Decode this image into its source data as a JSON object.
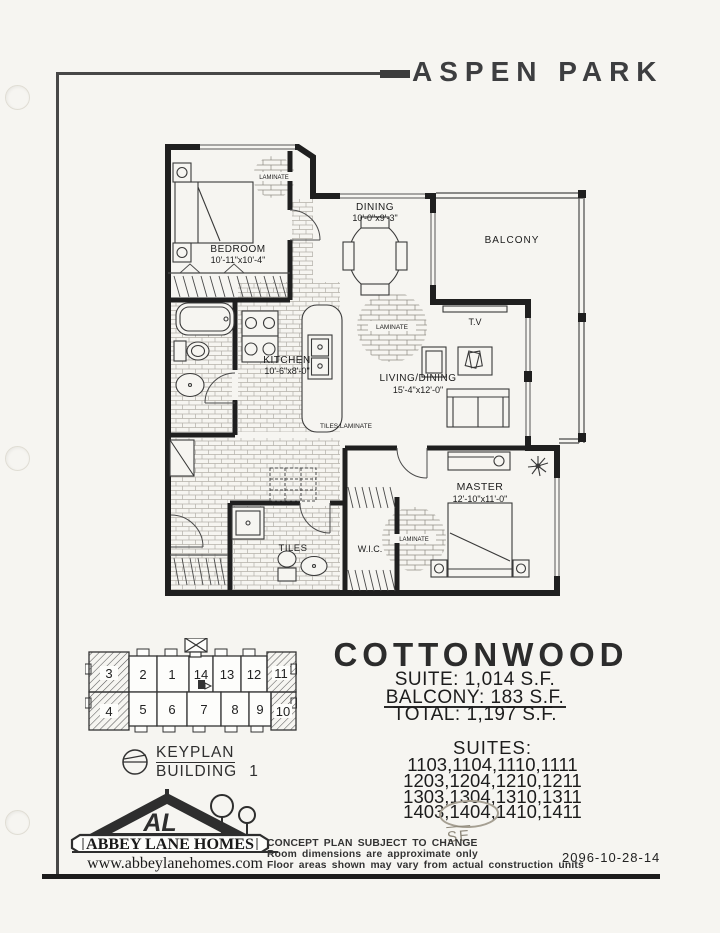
{
  "header": {
    "title": "ASPEN PARK"
  },
  "floorplan": {
    "rooms": {
      "bedroom": {
        "name": "BEDROOM",
        "dims": "10'-11\"x10'-4\""
      },
      "dining": {
        "name": "DINING",
        "dims": "10'-0\"x9'-3\""
      },
      "balcony": {
        "name": "BALCONY"
      },
      "kitchen": {
        "name": "KITCHEN",
        "dims": "10'-6\"x8'-0\""
      },
      "living": {
        "name": "LIVING/DINING",
        "dims": "15'-4\"x12'-0\""
      },
      "master": {
        "name": "MASTER",
        "dims": "12'-10\"x11'-0\""
      },
      "wic": {
        "name": "W.I.C."
      }
    },
    "labels": {
      "tv": "T.V",
      "tiles": "TILES",
      "tiles_laminate": "TILES LAMINATE",
      "laminate": "LAMINATE"
    }
  },
  "plan": {
    "name": "COTTONWOOD",
    "areas": [
      {
        "label": "SUITE:",
        "value": "1,014 S.F."
      },
      {
        "label": "BALCONY:",
        "value": "183 S.F."
      },
      {
        "label": "TOTAL:",
        "value": "1,197 S.F."
      }
    ],
    "suites": {
      "heading": "SUITES:",
      "rows": [
        "1103,1104,1110,1111",
        "1203,1204,1210,1211",
        "1303,1304,1310,1311",
        "1403,1404,1410,1411"
      ]
    },
    "handwritten_note": "SE"
  },
  "keyplan": {
    "title_line1": "KEYPLAN",
    "title_line2": "BUILDING",
    "building_number": "1",
    "top_units": [
      "3",
      "2",
      "1",
      "14",
      "13",
      "12",
      "11"
    ],
    "bottom_units": [
      "4",
      "5",
      "6",
      "7",
      "8",
      "9",
      "10"
    ]
  },
  "logo": {
    "monogram": "AL",
    "company": "ABBEY LANE HOMES",
    "website": "www.abbeylanehomes.com"
  },
  "footer": {
    "disclaimer": [
      "CONCEPT PLAN SUBJECT TO CHANGE",
      "Room dimensions are approximate only",
      "Floor areas shown may vary from actual construction units"
    ],
    "doc_number": "2096-10-28-14"
  }
}
